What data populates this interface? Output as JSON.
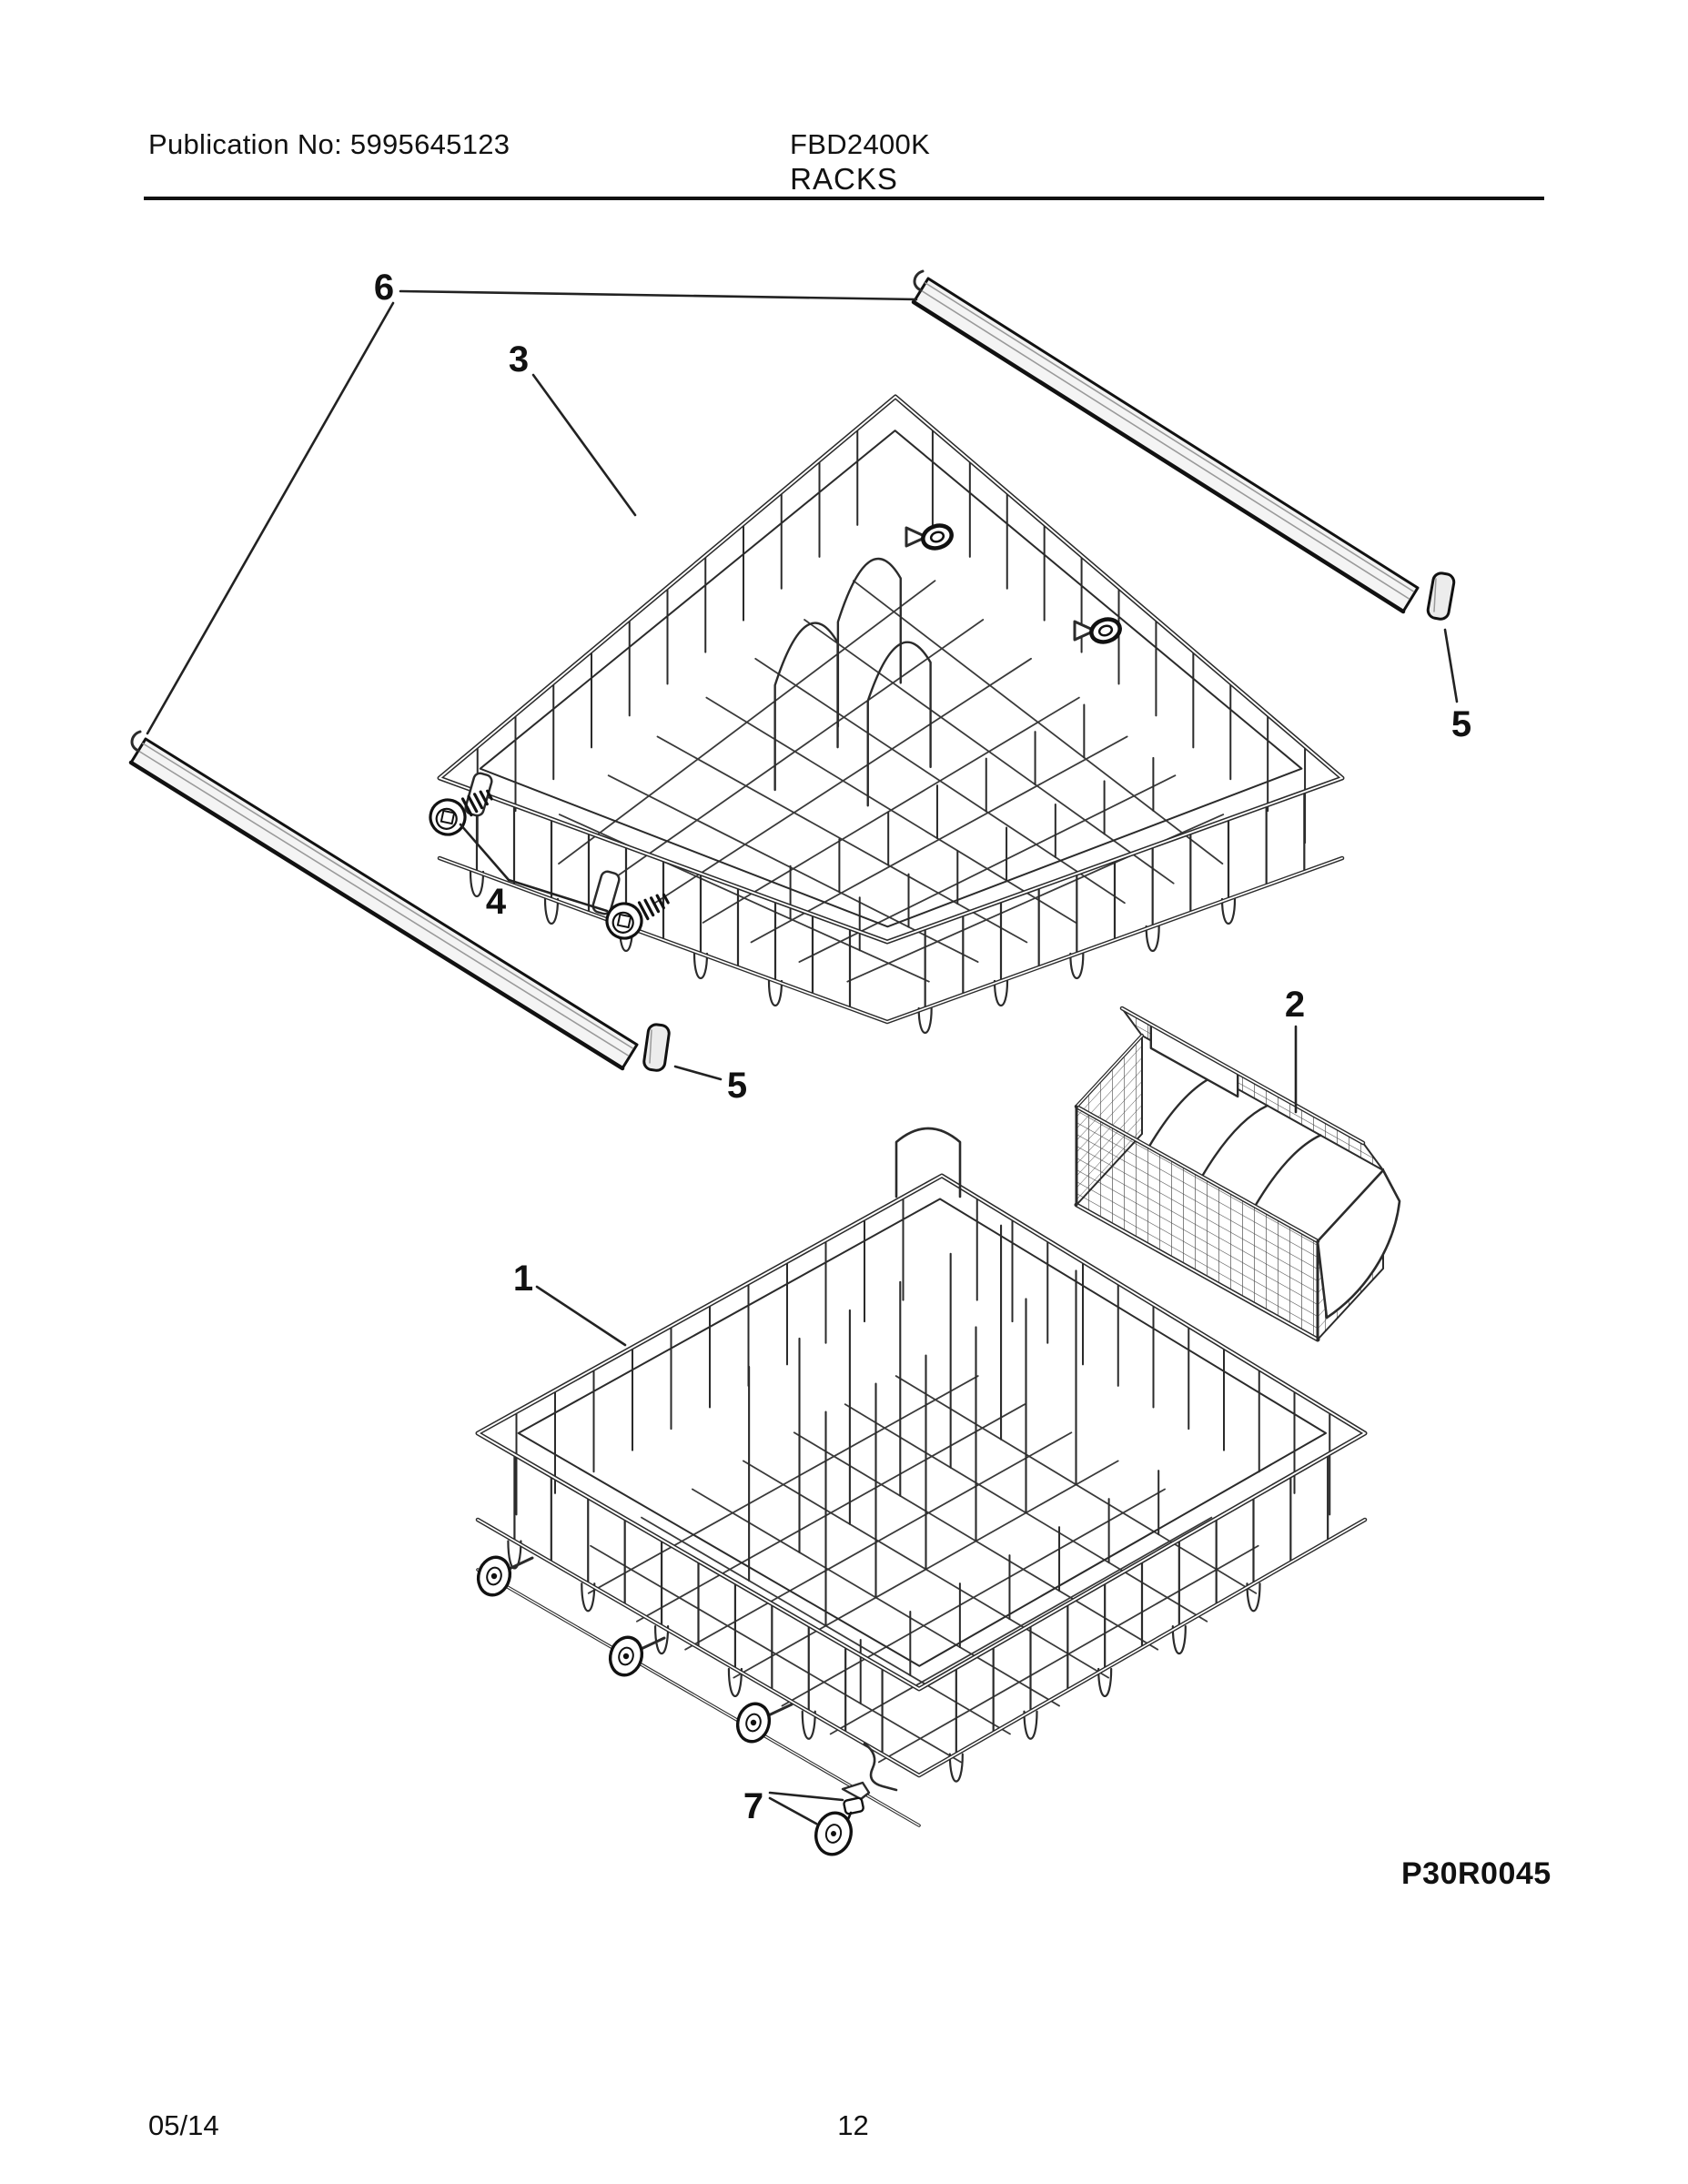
{
  "header": {
    "publication_label": "Publication No: 5995645123",
    "model": "FBD2400K"
  },
  "section": {
    "title": "RACKS"
  },
  "diagram": {
    "figure_code": "P30R0045",
    "callouts": {
      "lower_rack": "1",
      "silverware_basket": "2",
      "upper_rack": "3",
      "screws": "4",
      "end_cap_right": "5",
      "end_cap_left": "5",
      "rails": "6",
      "roller_wheel": "7"
    }
  },
  "footer": {
    "date": "05/14",
    "page_number": "12"
  },
  "colors": {
    "ink": "#111111",
    "wire": "#2b2b2b",
    "grid": "#3a3a3a",
    "mesh": "#4a4a4a",
    "leader": "#222222",
    "rail_fill": "#f4f4f4",
    "cap_fill": "#ececec",
    "highlight": "#9a9a9a"
  }
}
